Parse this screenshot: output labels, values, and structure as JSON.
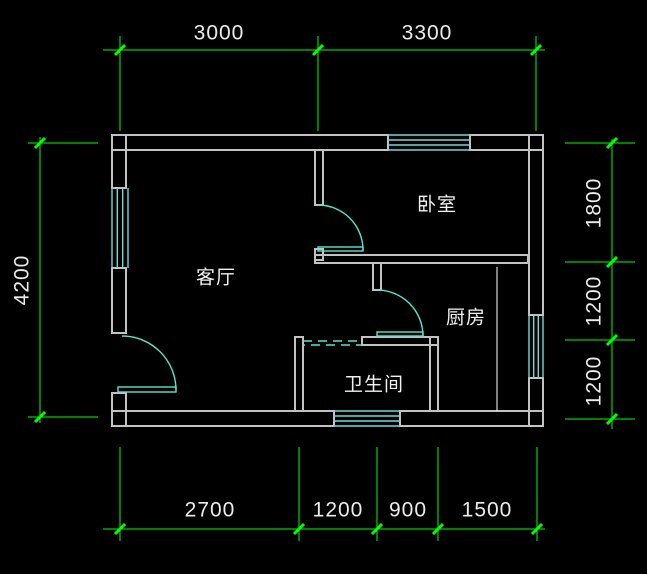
{
  "plan": {
    "rooms": {
      "living": "客厅",
      "bedroom": "卧室",
      "kitchen": "厨房",
      "bathroom": "卫生间"
    },
    "dimensions": {
      "top": [
        "3000",
        "3300"
      ],
      "bottom": [
        "2700",
        "1200",
        "900",
        "1500"
      ],
      "left": [
        "4200"
      ],
      "right": [
        "1800",
        "1200",
        "1200"
      ]
    },
    "colors": {
      "background": "#000000",
      "wall": "#c2c2c2",
      "window": "#72d9d9",
      "door": "#57e6cf",
      "dimension": "#00ff00",
      "text": "#ececec"
    }
  }
}
